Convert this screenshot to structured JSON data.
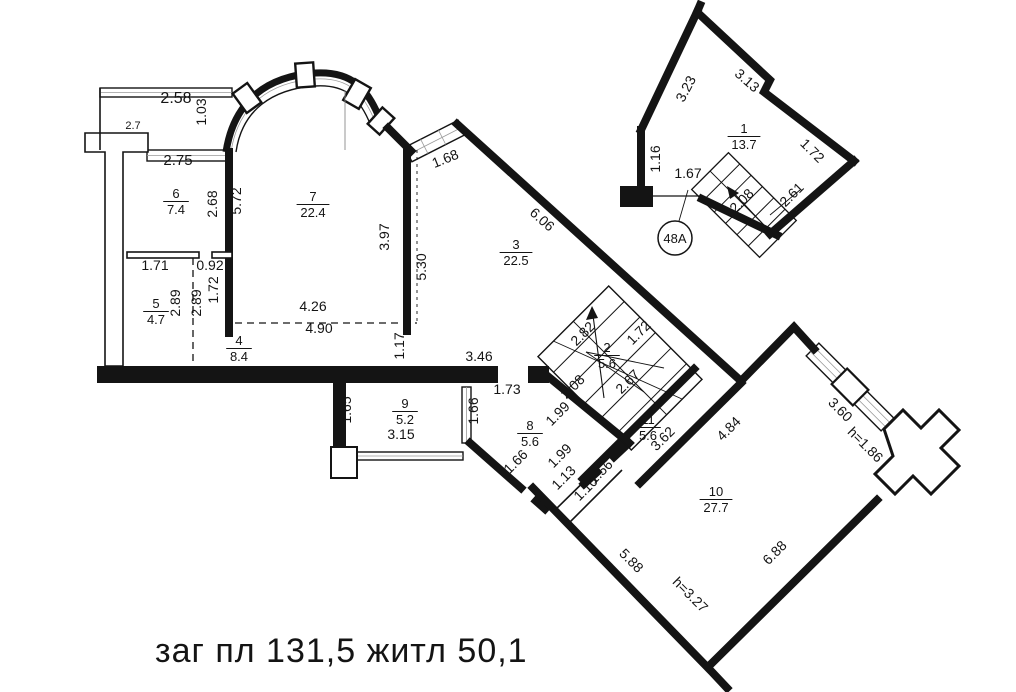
{
  "summary": {
    "text": "заг пл  131,5 житл  50,1"
  },
  "unit_badge": {
    "label": "48А"
  },
  "rooms": [
    {
      "number": "1",
      "area": "13.7",
      "x": 744,
      "y": 133
    },
    {
      "number": "2",
      "area": "5.6",
      "x": 607,
      "y": 352
    },
    {
      "number": "3",
      "area": "22.5",
      "x": 516,
      "y": 249
    },
    {
      "number": "4",
      "area": "8.4",
      "x": 239,
      "y": 345
    },
    {
      "number": "5",
      "area": "4.7",
      "x": 156,
      "y": 308
    },
    {
      "number": "6",
      "area": "7.4",
      "x": 176,
      "y": 198
    },
    {
      "number": "7",
      "area": "22.4",
      "x": 313,
      "y": 201
    },
    {
      "number": "8",
      "area": "5.6",
      "x": 530,
      "y": 430
    },
    {
      "number": "9",
      "area": "5.2",
      "x": 405,
      "y": 408
    },
    {
      "number": "10",
      "area": "27.7",
      "x": 716,
      "y": 496
    },
    {
      "number": "11",
      "area": "5.6",
      "x": 648,
      "y": 424
    }
  ],
  "dimensions": [
    {
      "t": "2.58",
      "x": 176,
      "y": 103,
      "r": 0,
      "s": 16
    },
    {
      "t": "2.7",
      "x": 133,
      "y": 129,
      "r": 0,
      "s": 11
    },
    {
      "t": "1.03",
      "x": 206,
      "y": 112,
      "r": -90,
      "s": 14
    },
    {
      "t": "2.75",
      "x": 178,
      "y": 165,
      "r": 0,
      "s": 15
    },
    {
      "t": "2.68",
      "x": 217,
      "y": 204,
      "r": -90,
      "s": 14
    },
    {
      "t": "5.72",
      "x": 241,
      "y": 201,
      "r": -90,
      "s": 14
    },
    {
      "t": "3.97",
      "x": 389,
      "y": 237,
      "r": -90,
      "s": 14
    },
    {
      "t": "1.71",
      "x": 155,
      "y": 270,
      "r": 0,
      "s": 14
    },
    {
      "t": "0.92",
      "x": 210,
      "y": 270,
      "r": 0,
      "s": 14
    },
    {
      "t": "1.72",
      "x": 218,
      "y": 290,
      "r": -90,
      "s": 14
    },
    {
      "t": "2.89",
      "x": 180,
      "y": 303,
      "r": -90,
      "s": 14
    },
    {
      "t": "2.89",
      "x": 201,
      "y": 303,
      "r": -90,
      "s": 14
    },
    {
      "t": "4.26",
      "x": 313,
      "y": 311,
      "r": 0,
      "s": 14
    },
    {
      "t": "4.90",
      "x": 319,
      "y": 333,
      "r": 0,
      "s": 14
    },
    {
      "t": "1.17",
      "x": 404,
      "y": 346,
      "r": -90,
      "s": 14
    },
    {
      "t": "6.06",
      "x": 539,
      "y": 223,
      "r": 42,
      "s": 14
    },
    {
      "t": "5.30",
      "x": 426,
      "y": 267,
      "r": -90,
      "s": 14
    },
    {
      "t": "1.68",
      "x": 447,
      "y": 163,
      "r": -22,
      "s": 14
    },
    {
      "t": "3.46",
      "x": 479,
      "y": 361,
      "r": 0,
      "s": 14
    },
    {
      "t": "1.73",
      "x": 507,
      "y": 394,
      "r": 0,
      "s": 14
    },
    {
      "t": "1.65",
      "x": 351,
      "y": 410,
      "r": -90,
      "s": 14
    },
    {
      "t": "3.15",
      "x": 401,
      "y": 439,
      "r": 0,
      "s": 14
    },
    {
      "t": "1.66",
      "x": 478,
      "y": 411,
      "r": -90,
      "s": 14
    },
    {
      "t": "1.66",
      "x": 519,
      "y": 465,
      "r": -45,
      "s": 14
    },
    {
      "t": "1.99",
      "x": 561,
      "y": 417,
      "r": -45,
      "s": 14
    },
    {
      "t": "1.99",
      "x": 563,
      "y": 459,
      "r": -45,
      "s": 14
    },
    {
      "t": "1.13",
      "x": 567,
      "y": 481,
      "r": -45,
      "s": 14
    },
    {
      "t": "1.10",
      "x": 589,
      "y": 492,
      "r": -45,
      "s": 14
    },
    {
      "t": "1.56",
      "x": 604,
      "y": 475,
      "r": -45,
      "s": 14
    },
    {
      "t": "2.82",
      "x": 586,
      "y": 337,
      "r": -45,
      "s": 14
    },
    {
      "t": "1.72",
      "x": 642,
      "y": 336,
      "r": -45,
      "s": 14
    },
    {
      "t": "2.08",
      "x": 576,
      "y": 390,
      "r": -45,
      "s": 14
    },
    {
      "t": "2.67",
      "x": 631,
      "y": 385,
      "r": -45,
      "s": 14
    },
    {
      "t": "3.62",
      "x": 666,
      "y": 442,
      "r": -45,
      "s": 14
    },
    {
      "t": "4.84",
      "x": 732,
      "y": 432,
      "r": -45,
      "s": 14
    },
    {
      "t": "3.60",
      "x": 837,
      "y": 413,
      "r": 45,
      "s": 14
    },
    {
      "t": "h=1.86",
      "x": 862,
      "y": 448,
      "r": 45,
      "s": 14
    },
    {
      "t": "6.88",
      "x": 778,
      "y": 556,
      "r": -45,
      "s": 14
    },
    {
      "t": "5.88",
      "x": 628,
      "y": 564,
      "r": 45,
      "s": 14
    },
    {
      "t": "h=3.27",
      "x": 687,
      "y": 598,
      "r": 45,
      "s": 14
    },
    {
      "t": "3.23",
      "x": 690,
      "y": 91,
      "r": -62,
      "s": 14
    },
    {
      "t": "3.13",
      "x": 744,
      "y": 84,
      "r": 41,
      "s": 14
    },
    {
      "t": "1.72",
      "x": 809,
      "y": 154,
      "r": 45,
      "s": 14
    },
    {
      "t": "1.16",
      "x": 660,
      "y": 159,
      "r": -90,
      "s": 14
    },
    {
      "t": "1.67",
      "x": 688,
      "y": 178,
      "r": 0,
      "s": 14
    },
    {
      "t": "2.08",
      "x": 745,
      "y": 204,
      "r": -45,
      "s": 14
    },
    {
      "t": "2.61",
      "x": 795,
      "y": 198,
      "r": -45,
      "s": 14
    }
  ]
}
